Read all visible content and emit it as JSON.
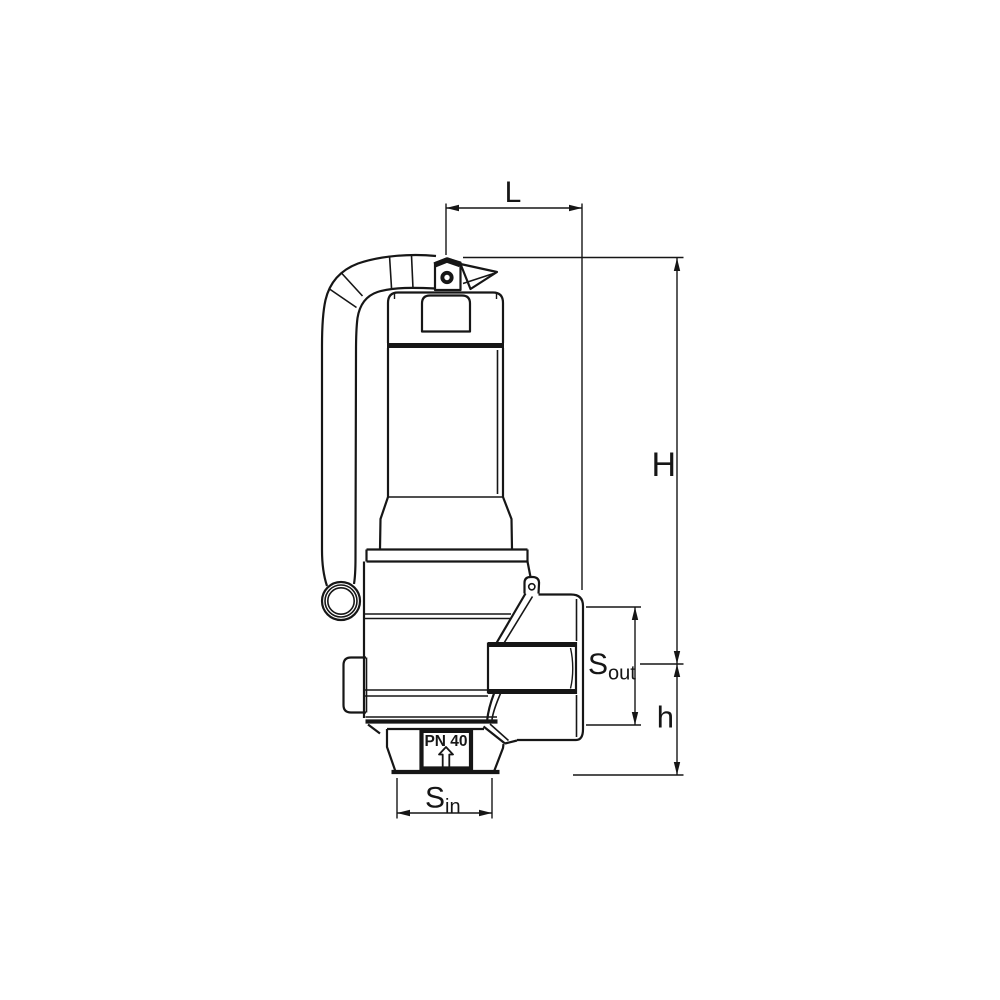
{
  "page": {
    "background": "#ffffff"
  },
  "drawing": {
    "kind": "safety-relief-valve-side-view",
    "line_color": "#161616",
    "labels": {
      "L": "L",
      "H": "H",
      "h": "h",
      "S_out_main": "S",
      "S_out_sub": "out",
      "S_in_main": "S",
      "S_in_sub": "in",
      "pn_rating": "PN 40"
    }
  }
}
